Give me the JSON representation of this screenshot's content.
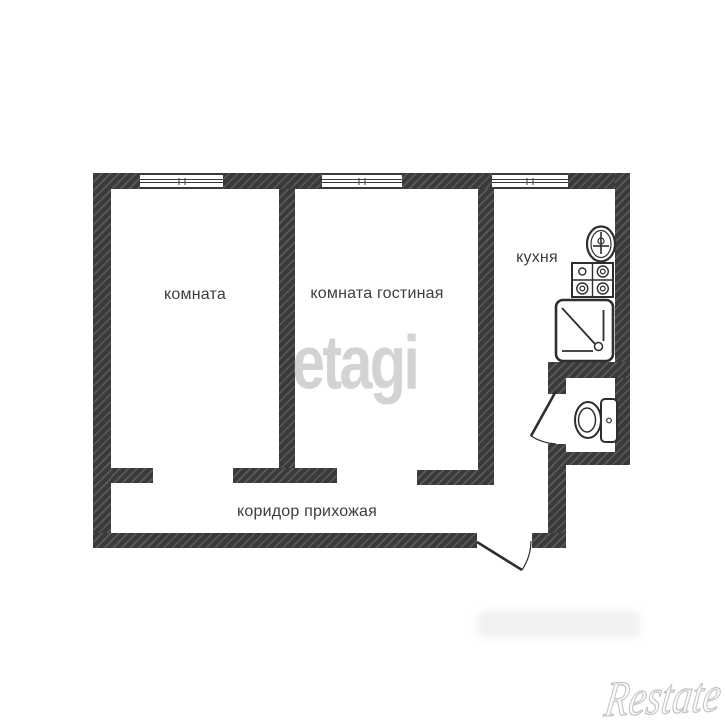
{
  "floor_plan": {
    "type": "apartment-floor-plan",
    "rooms": [
      {
        "id": "room",
        "label": "комната"
      },
      {
        "id": "living-room",
        "label": "комната гостиная"
      },
      {
        "id": "kitchen",
        "label": "кухня"
      },
      {
        "id": "corridor",
        "label": "коридор прихожая"
      }
    ],
    "windows_count": 3,
    "fixtures": [
      "kitchen-sink",
      "stove-4-burners",
      "shower-tray",
      "toilet-with-tank"
    ],
    "door_openings": [
      "bathroom-door-swing",
      "entrance-door-swing"
    ],
    "colors": {
      "wall": "#3a3a3a",
      "label_text": "#3d3d3d",
      "fixture_line": "#2e2e2e",
      "watermark_center": "#d5d5d4",
      "watermark_corner": "#c4c4c4"
    }
  },
  "watermarks": {
    "center": "etagi",
    "bottom_right": "Restate"
  }
}
